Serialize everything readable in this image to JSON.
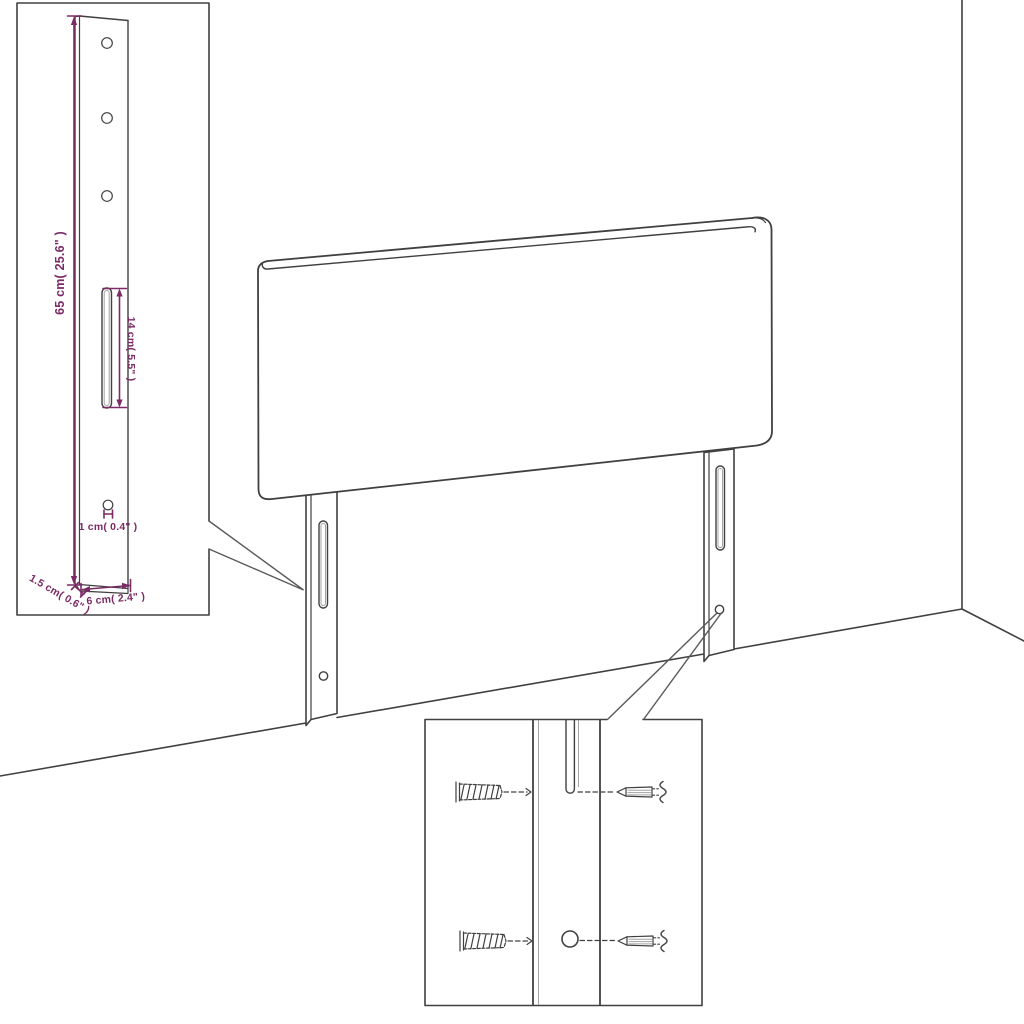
{
  "meta": {
    "kind": "furniture-assembly-dimension-diagram",
    "background": "#ffffff"
  },
  "colors": {
    "line": "#404040",
    "line_light": "#a3a3a3",
    "dimension": "#7b2a66",
    "background": "#ffffff"
  },
  "labels": {
    "leg_height": "65 cm( 25.6\" )",
    "slot_length": "14 cm( 5.5\" )",
    "hole_diameter": "1 cm( 0.4\" )",
    "leg_thickness": "1.5 cm( 0.6\" )",
    "leg_width": "6 cm( 2.4\" )"
  },
  "icons": {
    "wall_plug": "hatched-wall-anchor",
    "screw": "side-view-screw",
    "slot": "vertical-mounting-slot",
    "hole": "round-mounting-hole"
  }
}
